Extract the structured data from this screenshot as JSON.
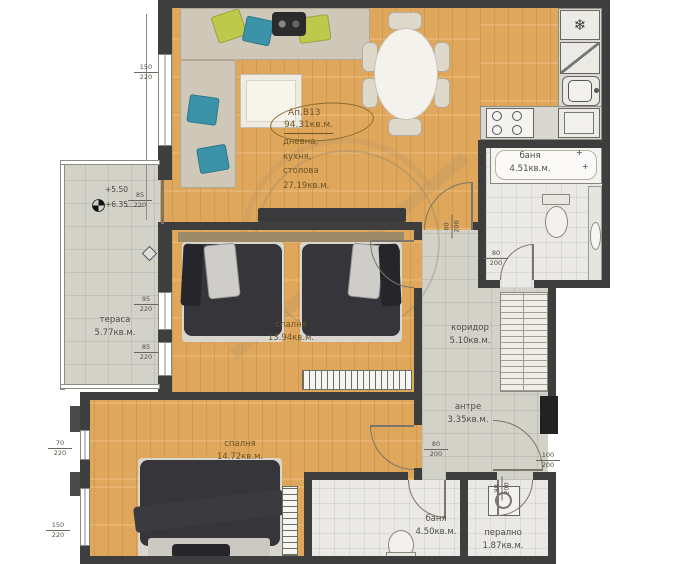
{
  "apartment": {
    "code": "Ап.В13",
    "area": "94.31кв.м."
  },
  "rooms": {
    "living": {
      "line1": "дневна,",
      "line2": "кухня,",
      "line3": "столова",
      "area": "27.19кв.м."
    },
    "bedroom1": {
      "name": "спалня",
      "area": "13.94кв.м."
    },
    "bedroom2": {
      "name": "спалня",
      "area": "14.72кв.м."
    },
    "terrace": {
      "name": "тераса",
      "area": "5.77кв.м."
    },
    "bath1": {
      "name": "баня",
      "area": "4.51кв.м."
    },
    "corridor": {
      "name": "коридор",
      "area": "5.10кв.м."
    },
    "antre": {
      "name": "антре",
      "area": "3.35кв.м."
    },
    "bath2": {
      "name": "баня",
      "area": "4.50кв.м."
    },
    "laundry": {
      "name": "перално",
      "area": "1.87кв.м."
    }
  },
  "elevations": {
    "upper": "+5.50",
    "lower": "+6.35"
  },
  "dims": {
    "win_tl": {
      "w": "150",
      "h": "220"
    },
    "ter_door": {
      "w": "85",
      "h": "220"
    },
    "ter_win1": {
      "w": "95",
      "h": "220"
    },
    "ter_win2": {
      "w": "85",
      "h": "220"
    },
    "bed2_win1": {
      "w": "70",
      "h": "220"
    },
    "bed2_win2": {
      "w": "150",
      "h": "220"
    },
    "door_bed1": {
      "w": "80",
      "h": "200"
    },
    "door_bath1": {
      "w": "80",
      "h": "200"
    },
    "door_bed2": {
      "w": "80",
      "h": "200"
    },
    "door_bath2": {
      "w": "90",
      "h": "200"
    },
    "door_entry": {
      "w": "100",
      "h": "200"
    }
  },
  "icons": {
    "fridge": "❄",
    "faucet": "+"
  },
  "colors": {
    "wood": "#dfa75c",
    "tile": "#d3d2c9",
    "wall": "#3e3e3e",
    "pillow_teal": "#3a93a8",
    "pillow_green": "#bcc94b"
  }
}
